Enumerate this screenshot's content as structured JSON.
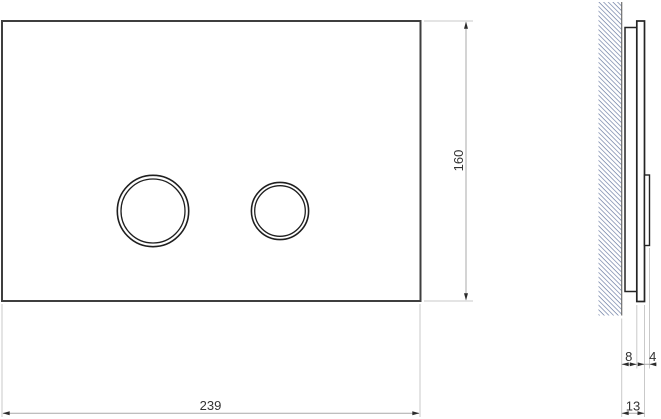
{
  "drawing": {
    "front_view": {
      "plate_outline": "flush-plate-front",
      "large_button": "large-flush-button",
      "small_button": "small-flush-button"
    },
    "side_view": {
      "wall": "hatched-wall-section",
      "frame": "mounting-frame-profile",
      "plate": "plate-profile",
      "button": "button-protrusion-profile"
    },
    "dimensions": {
      "plate_height": "160",
      "plate_width": "239",
      "frame_depth": "8",
      "button_protrusion": "4",
      "total_depth": "13"
    },
    "colors": {
      "front_outline": "#3f3f3f",
      "profile_outline": "#242424",
      "dimension_line": "#a9a9a9",
      "extension_line": "#c9c9c9",
      "wall_hatch": "#6b7ca3",
      "dimension_text": "#333333",
      "background": "#ffffff"
    }
  }
}
